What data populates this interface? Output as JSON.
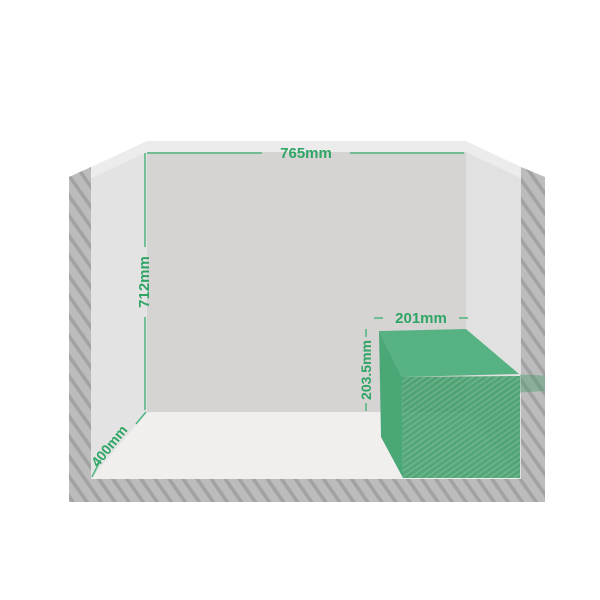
{
  "diagram": {
    "type": "trunk-dimension-diagram",
    "labels": {
      "width_top": "765mm",
      "height_left": "712mm",
      "depth_floor": "400mm",
      "box_width": "201mm",
      "box_height": "203.5mm"
    },
    "colors": {
      "background": "#ffffff",
      "frame": "#bcbcbc",
      "frame_stripe": "#a2a2a2",
      "rim": "#ececec",
      "wall_side_left": "#e3e3e3",
      "wall_side_right": "#e1e1e1",
      "wall_back": "#d5d4d3",
      "floor": "#f0efee",
      "box_top": "#56b283",
      "box_side": "#4aa877",
      "box_front": "#389a64",
      "box_front_stripe": "#ffffff",
      "accent_line": "#4fb37e",
      "accent_text": "#2fa565"
    }
  }
}
